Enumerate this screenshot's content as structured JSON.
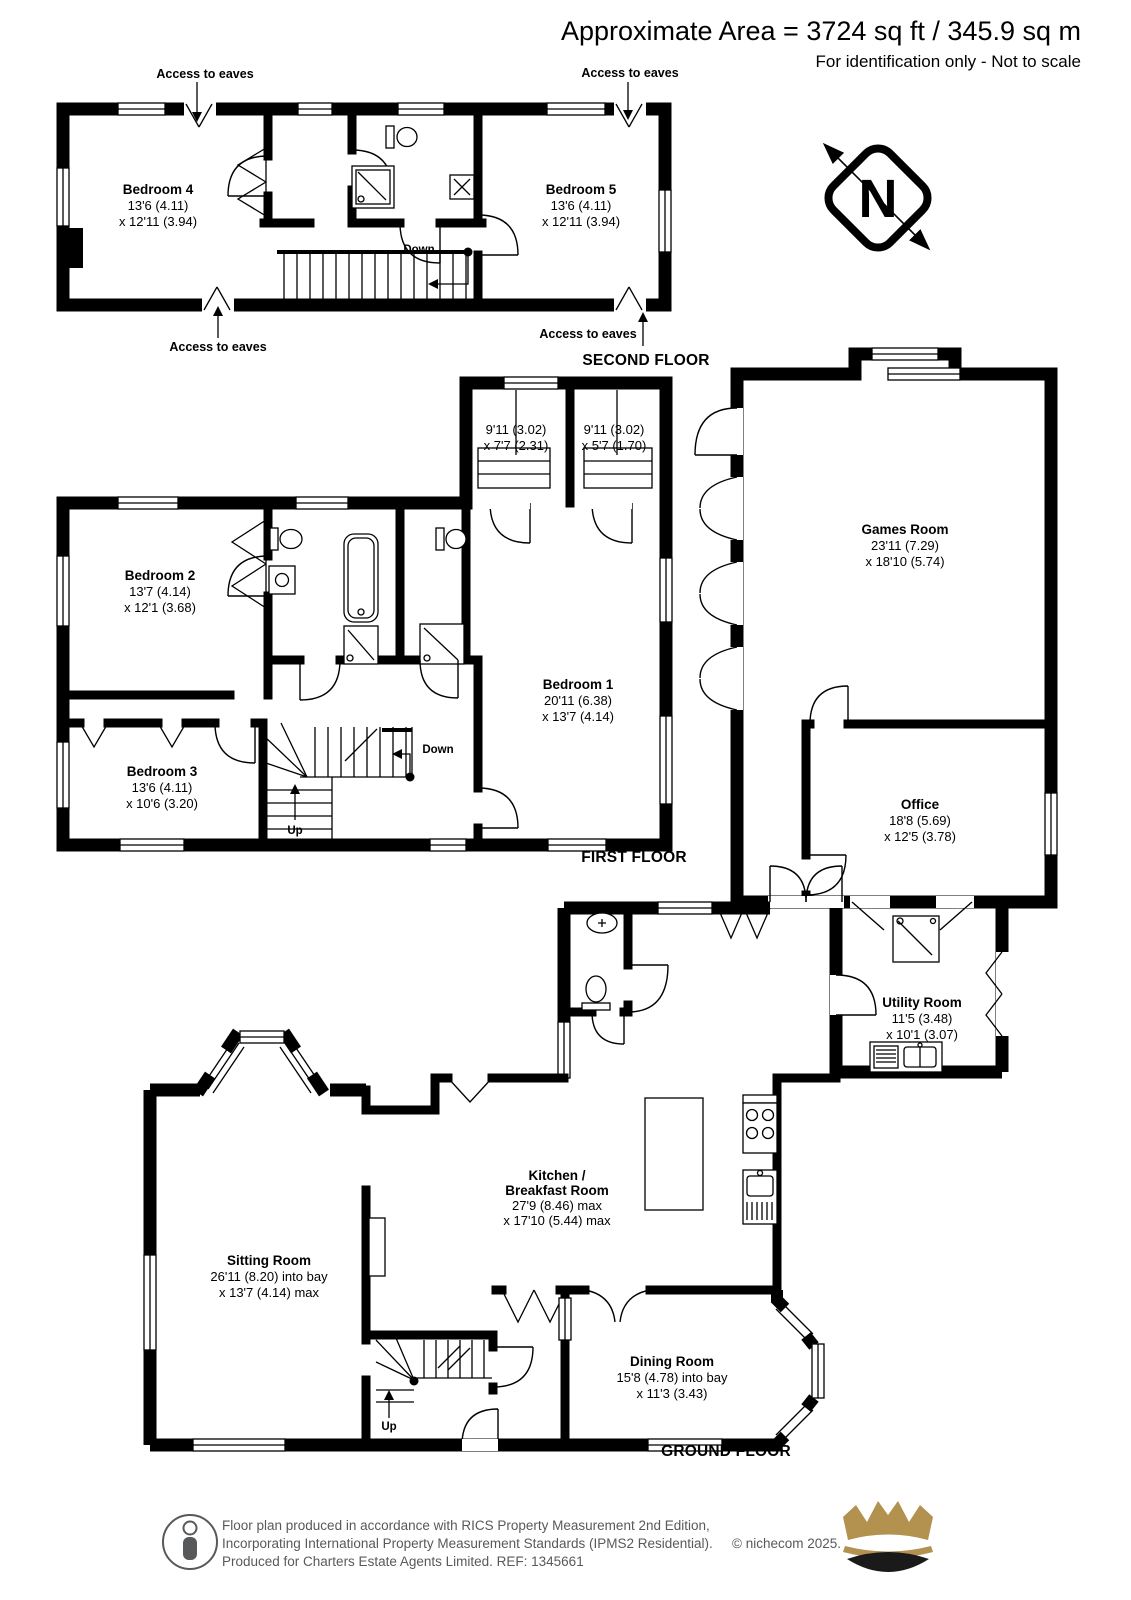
{
  "header": {
    "area": "Approximate Area = 3724 sq ft / 345.9 sq m",
    "note": "For identification only - Not to scale"
  },
  "compass": {
    "n": "N"
  },
  "annotations": {
    "access_to_eaves": "Access to eaves",
    "down": "Down",
    "up": "Up"
  },
  "floors": {
    "second": "SECOND FLOOR",
    "first": "FIRST FLOOR",
    "ground": "GROUND FLOOR"
  },
  "rooms": {
    "bedroom4": {
      "name": "Bedroom 4",
      "dim1": "13'6 (4.11)",
      "dim2": "x 12'11 (3.94)"
    },
    "bedroom5": {
      "name": "Bedroom 5",
      "dim1": "13'6 (4.11)",
      "dim2": "x 12'11 (3.94)"
    },
    "dressing_a": {
      "dim1": "9'11 (3.02)",
      "dim2": "x 7'7 (2.31)"
    },
    "dressing_b": {
      "dim1": "9'11 (3.02)",
      "dim2": "x 5'7 (1.70)"
    },
    "bedroom2": {
      "name": "Bedroom 2",
      "dim1": "13'7 (4.14)",
      "dim2": "x 12'1 (3.68)"
    },
    "bedroom3": {
      "name": "Bedroom 3",
      "dim1": "13'6 (4.11)",
      "dim2": "x 10'6 (3.20)"
    },
    "bedroom1": {
      "name": "Bedroom 1",
      "dim1": "20'11 (6.38)",
      "dim2": "x 13'7 (4.14)"
    },
    "games_room": {
      "name": "Games Room",
      "dim1": "23'11 (7.29)",
      "dim2": "x 18'10 (5.74)"
    },
    "office": {
      "name": "Office",
      "dim1": "18'8 (5.69)",
      "dim2": "x 12'5 (3.78)"
    },
    "utility": {
      "name": "Utility Room",
      "dim1": "11'5 (3.48)",
      "dim2": "x 10'1 (3.07)"
    },
    "kitchen": {
      "name_line1": "Kitchen /",
      "name_line2": "Breakfast Room",
      "dim1": "27'9 (8.46) max",
      "dim2": "x 17'10 (5.44) max"
    },
    "sitting": {
      "name": "Sitting Room",
      "dim1": "26'11 (8.20) into bay",
      "dim2": "x 13'7 (4.14) max"
    },
    "dining": {
      "name": "Dining Room",
      "dim1": "15'8 (4.78) into bay",
      "dim2": "x 11'3 (3.43)"
    }
  },
  "footer": {
    "line1": "Floor plan produced in accordance with RICS Property Measurement 2nd Edition,",
    "line2": "Incorporating International Property Measurement Standards (IPMS2 Residential).",
    "copyright": "© nichecom 2025.",
    "line3": "Produced for Charters Estate Agents Limited.   REF: 1345661"
  },
  "colors": {
    "wall": "#000000",
    "crown_gold": "#b3914f",
    "footer_text": "#58595b"
  }
}
